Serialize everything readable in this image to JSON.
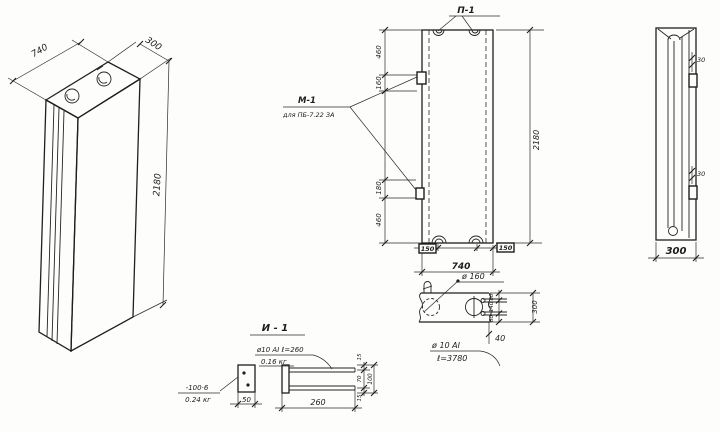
{
  "sheet": {
    "title": "panel-working-drawing"
  },
  "iso": {
    "dim_width": "740",
    "dim_depth": "300",
    "dim_height": "2180"
  },
  "front": {
    "loop_label": "П-1",
    "embed_label": "М-1",
    "embed_note": "для ПБ-7.22 ЗА",
    "dim_top": "460",
    "dim_embed1": "160",
    "dim_embed2": "180",
    "dim_bottom": "460",
    "dim_height": "2180",
    "dim_loop_left": "150",
    "dim_loop_right": "150",
    "dim_width": "740"
  },
  "plan": {
    "hole_label": "ø 160",
    "dim_s1": "80",
    "dim_s2": "140",
    "dim_s3": "80",
    "dim_depth": "300",
    "dim_offset": "40"
  },
  "side": {
    "dim_embed_top": "30",
    "dim_embed_bottom": "30",
    "dim_width": "300"
  },
  "detail": {
    "title": "И - 1",
    "plate_size": "-100·6",
    "plate_mass": "0.24 кг",
    "plate_width": "50",
    "bar_spec": "ø10 АI ℓ=260",
    "bar_mass": "0.16 кг",
    "dim_length": "260",
    "dim_t1": "15",
    "dim_mid": "70",
    "dim_t2": "15",
    "dim_total": "100"
  },
  "note": {
    "line1": "ø 10 АI",
    "line2": "ℓ=3780"
  }
}
